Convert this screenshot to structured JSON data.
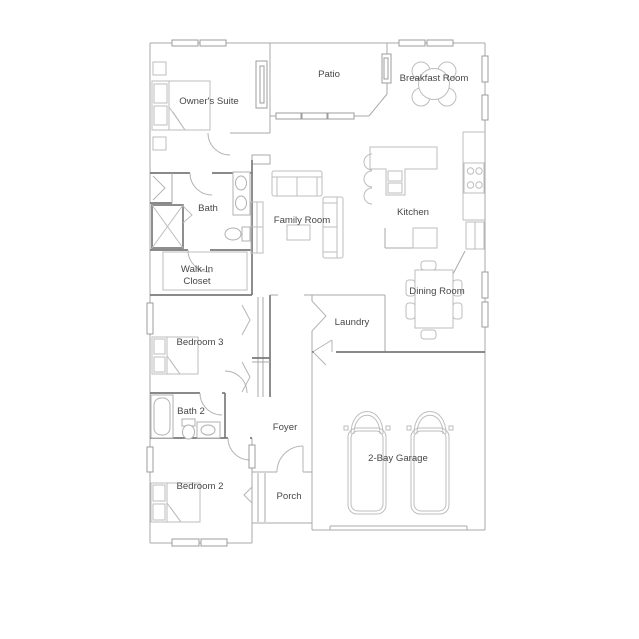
{
  "plan_title": "single-story house floor plan",
  "rooms": {
    "owners_suite": {
      "label": "Owner's Suite"
    },
    "patio": {
      "label": "Patio"
    },
    "breakfast_room": {
      "label": "Breakfast Room"
    },
    "bath": {
      "label": "Bath"
    },
    "family_room": {
      "label": "Family Room"
    },
    "kitchen": {
      "label": "Kitchen"
    },
    "walk_in_closet": {
      "line1": "Walk-In",
      "line2": "Closet"
    },
    "dining_room": {
      "label": "Dining Room"
    },
    "bedroom_3": {
      "label": "Bedroom 3"
    },
    "laundry": {
      "label": "Laundry"
    },
    "bath_2": {
      "label": "Bath 2"
    },
    "foyer": {
      "label": "Foyer"
    },
    "bedroom_2": {
      "label": "Bedroom 2"
    },
    "porch": {
      "label": "Porch"
    },
    "garage": {
      "label": "2-Bay Garage"
    }
  },
  "colors": {
    "background": "#ffffff",
    "wall_light": "#a9a9a9",
    "wall_dark": "#7a7a7a",
    "furniture": "#bdbdbd",
    "label_text": "#474747"
  }
}
